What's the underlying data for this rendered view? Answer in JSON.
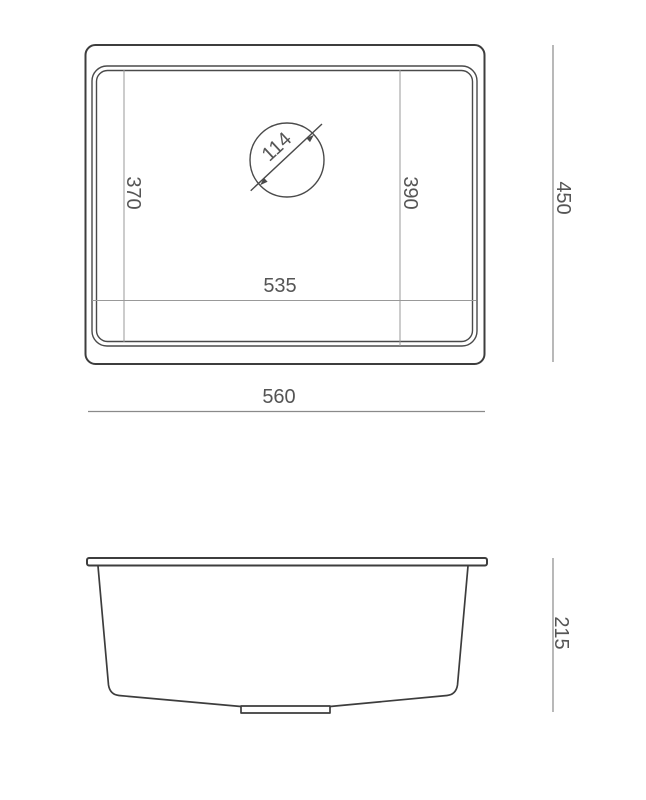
{
  "dimensions": {
    "overall_width": "560",
    "overall_depth": "450",
    "bowl_inner_width": "535",
    "bowl_depth_left": "370",
    "bowl_depth_right": "390",
    "drain_diameter": "114",
    "bowl_height": "215"
  },
  "colors": {
    "bg": "#ffffff",
    "outline": "#3d3d3d",
    "rim": "#4a4a4a",
    "thin": "#999999",
    "dim": "#8a8a8a",
    "text": "#555555"
  }
}
